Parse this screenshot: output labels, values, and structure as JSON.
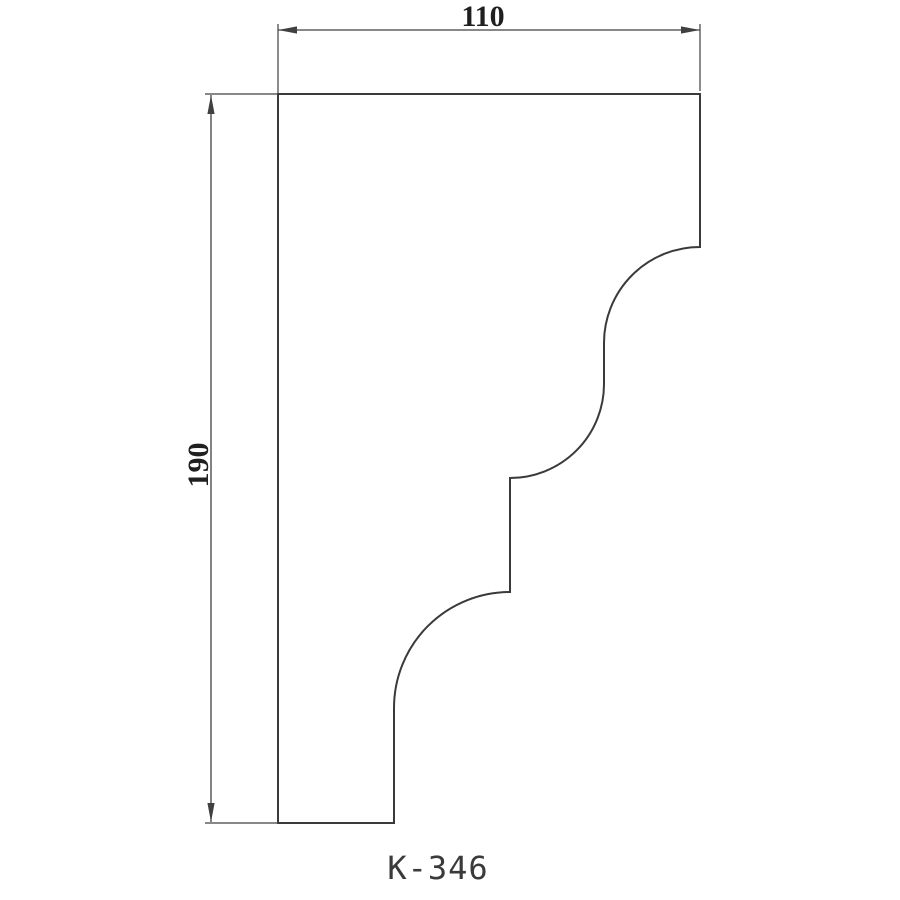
{
  "drawing": {
    "title": "K-346",
    "width_dimension": "110",
    "height_dimension": "190",
    "profile_path": "M 278 94 H 700 V 247 A 96 96 0 0 0 604 343 V 384 A 94 94 0 0 1 510 478 V 592 A 116 116 0 0 0 394 708 V 823 H 278 Z",
    "colors": {
      "outline": "#3a3a3a",
      "dimension_lines": "#404040",
      "dimension_text": "#1f1f1f",
      "title_text": "#3a3a3a",
      "background": "#ffffff"
    }
  }
}
